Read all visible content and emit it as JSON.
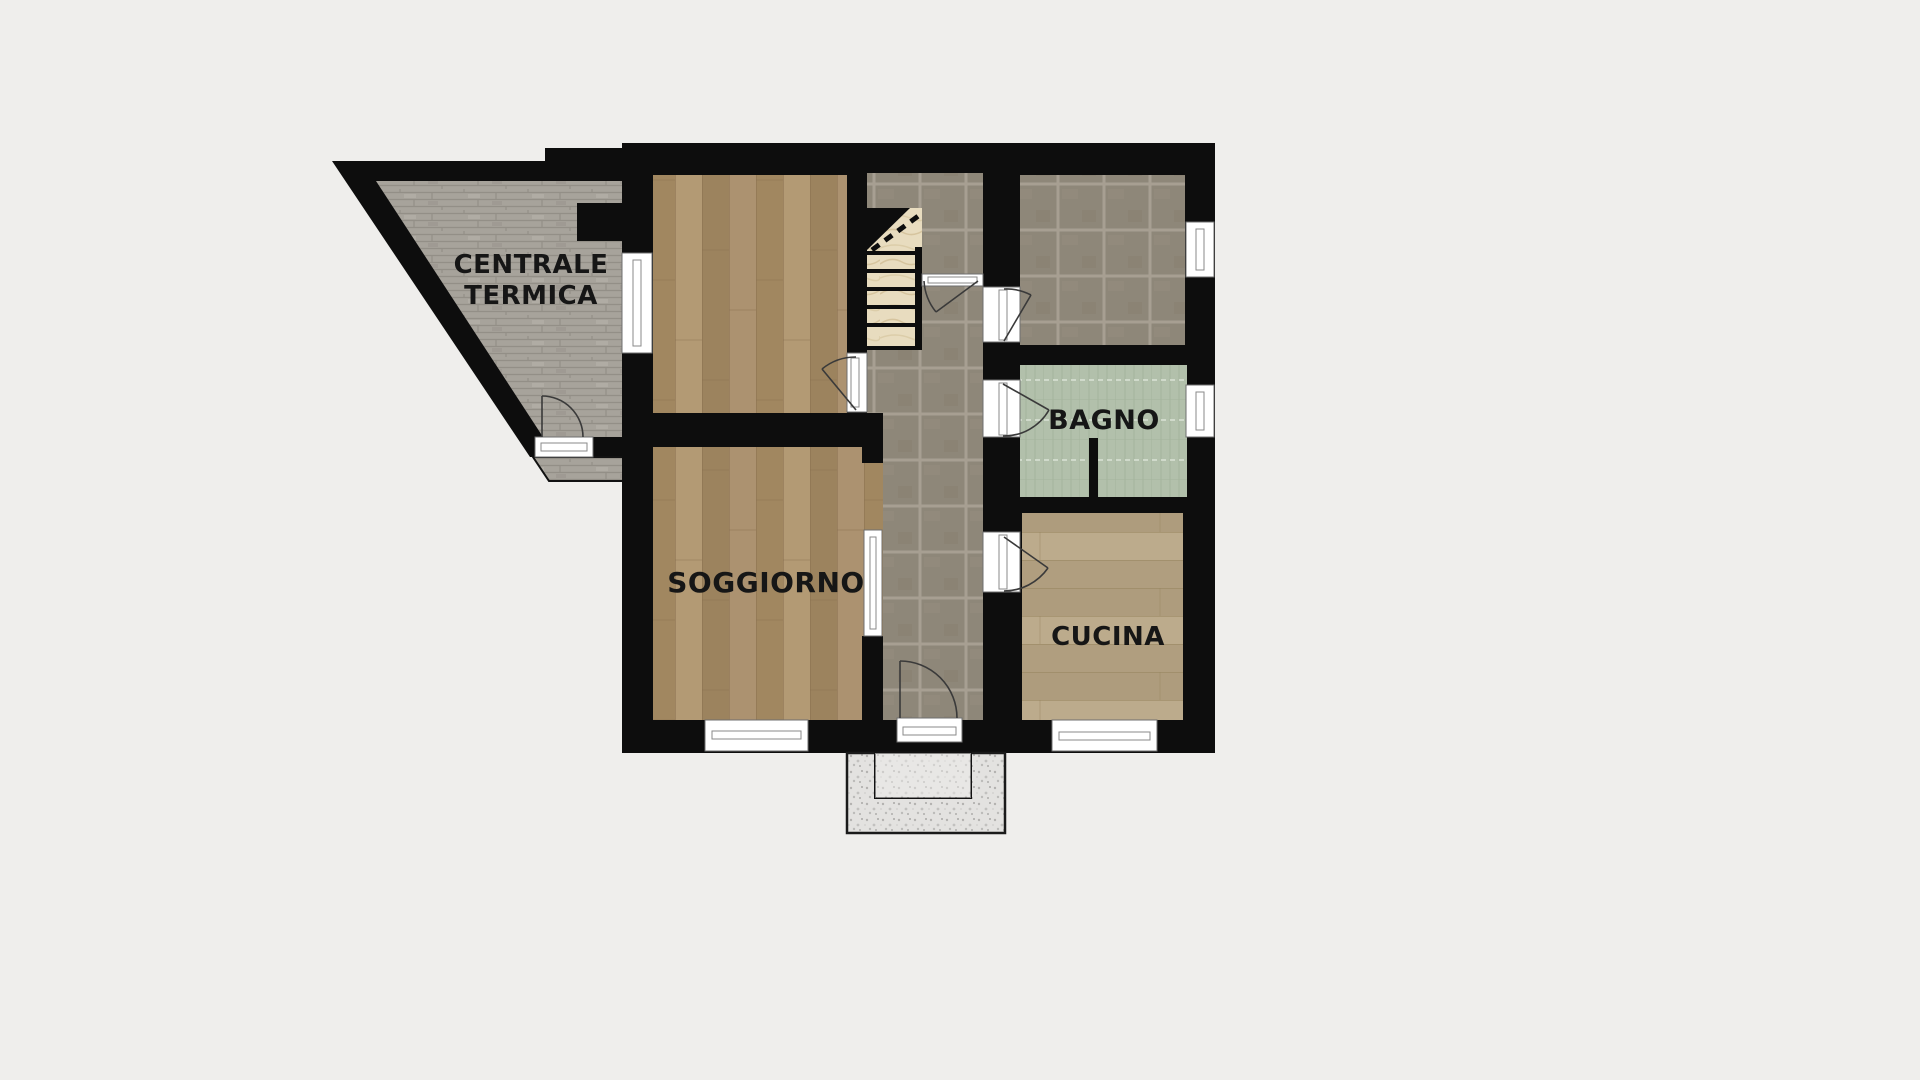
{
  "plan": {
    "type": "residential-floor-plan",
    "rooms": {
      "centrale_termica": {
        "line1": "CENTRALE",
        "line2": "TERMICA"
      },
      "soggiorno": {
        "label": "SOGGIORNO"
      },
      "bagno": {
        "label": "BAGNO"
      },
      "cucina": {
        "label": "CUCINA"
      }
    }
  },
  "colors": {
    "background": "#efeeec",
    "wall": "#0d0d0d",
    "label": "#161616",
    "door_line": "#3a3a3a",
    "wood_floor": "#a8906a",
    "wood_floor_kitchen": "#b4a283",
    "corridor_tile": "#8e8779",
    "tile_grout": "#a79f92",
    "stone_annex": "#a7a39b",
    "bagno_green": "#b2c0ab",
    "stair_cream": "#e8dcbf",
    "porch_concrete": "#e3e2e0"
  }
}
